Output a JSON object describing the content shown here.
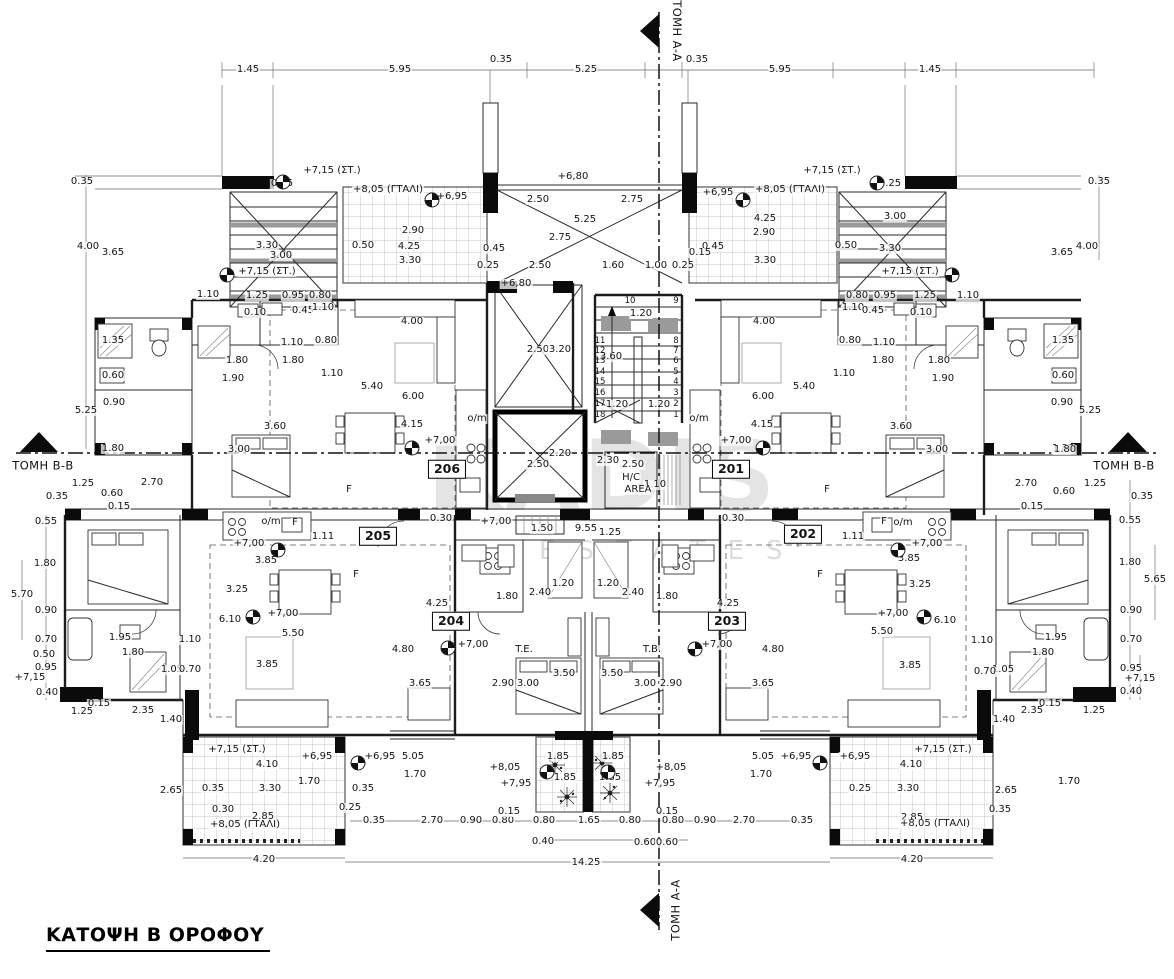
{
  "title": {
    "text": "ΚΑΤΟΨΗ Β ΟΡΟΦΟΥ"
  },
  "watermark": {
    "line1": "KADIS",
    "line2": "ESTATES"
  },
  "colors": {
    "paper": "#ffffff",
    "line": "#1c1c1c",
    "tile_grid": "#c4c4c4",
    "gray_fill": "#9a9a9a",
    "watermark": "#e4e4e4"
  },
  "section_markers": [
    {
      "position": "top",
      "label": "ΤΟΜΗ Α-Α"
    },
    {
      "position": "bottom",
      "label": "ΤΟΜΗ Α-Α"
    },
    {
      "position": "left",
      "label": "ΤΟΜΗ Β-Β"
    },
    {
      "position": "right",
      "label": "ΤΟΜΗ Β-Β"
    }
  ],
  "apartments": [
    "201",
    "202",
    "203",
    "204",
    "205",
    "206"
  ],
  "plan": {
    "label_format": "[text, x, y, class?, rotation?] class: r=room-box, s=stair-tread, m=section-marker",
    "labels": [
      [
        "1.45",
        248,
        70
      ],
      [
        "5.95",
        400,
        70
      ],
      [
        "0.35",
        501,
        60
      ],
      [
        "5.25",
        586,
        70
      ],
      [
        "0.35",
        697,
        60
      ],
      [
        "5.95",
        780,
        70
      ],
      [
        "1.45",
        930,
        70
      ],
      [
        "0.35",
        82,
        182
      ],
      [
        "0.35",
        1099,
        182
      ],
      [
        "4.00",
        88,
        247
      ],
      [
        "3.65",
        113,
        253
      ],
      [
        "4.00",
        1087,
        247
      ],
      [
        "3.65",
        1062,
        253
      ],
      [
        "+7,15 (ΣΤ.)",
        332,
        171
      ],
      [
        "0.25",
        282,
        184
      ],
      [
        "+8,05 (ΓΤΑΛΙ)",
        388,
        190
      ],
      [
        "+6,95",
        452,
        197
      ],
      [
        "+6,80",
        573,
        177
      ],
      [
        "+6,95",
        718,
        193
      ],
      [
        "+8,05 (ΓΤΑΛΙ)",
        790,
        190
      ],
      [
        "+7,15 (ΣΤ.)",
        832,
        171
      ],
      [
        "0.25",
        890,
        184
      ],
      [
        "2.50",
        538,
        200
      ],
      [
        "2.75",
        632,
        200
      ],
      [
        "5.25",
        585,
        220
      ],
      [
        "2.75",
        560,
        238
      ],
      [
        "2.90",
        413,
        231
      ],
      [
        "4.25",
        409,
        247
      ],
      [
        "3.30",
        410,
        261
      ],
      [
        "0.50",
        363,
        246
      ],
      [
        "3.30",
        267,
        246
      ],
      [
        "3.00",
        281,
        256
      ],
      [
        "4.25",
        765,
        219
      ],
      [
        "2.90",
        764,
        233
      ],
      [
        "3.30",
        765,
        261
      ],
      [
        "0.50",
        846,
        246
      ],
      [
        "3.00",
        895,
        217
      ],
      [
        "3.30",
        890,
        249
      ],
      [
        "+7,15 (ΣΤ.)",
        267,
        272
      ],
      [
        "+7,15 (ΣΤ.)",
        910,
        272
      ],
      [
        "2.50",
        540,
        266
      ],
      [
        "1.60",
        613,
        266
      ],
      [
        "1.00",
        656,
        266
      ],
      [
        "0.25",
        683,
        266
      ],
      [
        "0.25",
        488,
        266
      ],
      [
        "0.45",
        494,
        249
      ],
      [
        "0.45",
        713,
        247
      ],
      [
        "0.15",
        700,
        253
      ],
      [
        "+6,80",
        516,
        284
      ],
      [
        "1.10",
        208,
        295
      ],
      [
        "1.25",
        257,
        296
      ],
      [
        "0.95",
        293,
        296
      ],
      [
        "0.80",
        320,
        296
      ],
      [
        "0.80",
        857,
        296
      ],
      [
        "0.95",
        885,
        296
      ],
      [
        "1.25",
        925,
        296
      ],
      [
        "1.10",
        968,
        296
      ],
      [
        "0.10",
        255,
        313
      ],
      [
        "0.45",
        303,
        311
      ],
      [
        "1.10",
        323,
        308
      ],
      [
        "1.10",
        853,
        308
      ],
      [
        "0.45",
        873,
        311
      ],
      [
        "0.10",
        921,
        313
      ],
      [
        "4.00",
        412,
        322
      ],
      [
        "4.00",
        764,
        322
      ],
      [
        "1.80",
        237,
        361
      ],
      [
        "1.90",
        233,
        379
      ],
      [
        "1.10",
        292,
        343
      ],
      [
        "1.80",
        293,
        361
      ],
      [
        "1.10",
        332,
        374
      ],
      [
        "0.80",
        326,
        341
      ],
      [
        "5.40",
        372,
        387
      ],
      [
        "6.00",
        413,
        397
      ],
      [
        "4.15",
        412,
        425
      ],
      [
        "+7,00",
        440,
        441
      ],
      [
        "o/m",
        477,
        419
      ],
      [
        "1.80",
        939,
        361
      ],
      [
        "1.90",
        943,
        379
      ],
      [
        "1.10",
        884,
        343
      ],
      [
        "1.80",
        883,
        361
      ],
      [
        "1.10",
        844,
        374
      ],
      [
        "0.80",
        850,
        341
      ],
      [
        "5.40",
        804,
        387
      ],
      [
        "6.00",
        763,
        397
      ],
      [
        "4.15",
        762,
        425
      ],
      [
        "+7,00",
        736,
        441
      ],
      [
        "o/m",
        699,
        419
      ],
      [
        "3.60",
        275,
        427
      ],
      [
        "3.00",
        239,
        450
      ],
      [
        "3.60",
        901,
        427
      ],
      [
        "3.00",
        937,
        450
      ],
      [
        "1.35",
        113,
        341
      ],
      [
        "0.60",
        113,
        376
      ],
      [
        "0.90",
        114,
        403
      ],
      [
        "5.25",
        86,
        411
      ],
      [
        "1.80",
        113,
        449
      ],
      [
        "1.35",
        1063,
        341
      ],
      [
        "0.60",
        1063,
        376
      ],
      [
        "0.90",
        1062,
        403
      ],
      [
        "5.25",
        1090,
        411
      ],
      [
        "1.80",
        1063,
        449
      ],
      [
        "2.50",
        538,
        350
      ],
      [
        "3.20",
        560,
        350
      ],
      [
        "1.20",
        641,
        314
      ],
      [
        "3.60",
        611,
        357
      ],
      [
        "1.20",
        617,
        405
      ],
      [
        "1.20",
        659,
        405
      ],
      [
        "10",
        630,
        301,
        "s"
      ],
      [
        "9",
        676,
        301,
        "s"
      ],
      [
        "11",
        600,
        341,
        "s"
      ],
      [
        "8",
        676,
        341,
        "s"
      ],
      [
        "12",
        600,
        351,
        "s"
      ],
      [
        "7",
        676,
        351,
        "s"
      ],
      [
        "13",
        600,
        361,
        "s"
      ],
      [
        "6",
        676,
        361,
        "s"
      ],
      [
        "14",
        600,
        372,
        "s"
      ],
      [
        "5",
        676,
        372,
        "s"
      ],
      [
        "15",
        600,
        382,
        "s"
      ],
      [
        "4",
        676,
        382,
        "s"
      ],
      [
        "16",
        600,
        393,
        "s"
      ],
      [
        "3",
        676,
        393,
        "s"
      ],
      [
        "17",
        600,
        404,
        "s"
      ],
      [
        "2",
        676,
        404,
        "s"
      ],
      [
        "18",
        600,
        415,
        "s"
      ],
      [
        "1",
        676,
        415,
        "s"
      ],
      [
        "2.20",
        560,
        454
      ],
      [
        "2.50",
        538,
        465
      ],
      [
        "2.30",
        608,
        461
      ],
      [
        "2.50",
        633,
        465
      ],
      [
        "1.10",
        655,
        485
      ],
      [
        "H/C",
        631,
        478
      ],
      [
        "AREA",
        638,
        490
      ],
      [
        "0.30",
        441,
        519
      ],
      [
        "+7,00",
        496,
        522
      ],
      [
        "1.50",
        542,
        529
      ],
      [
        "9.55",
        586,
        529
      ],
      [
        "1.25",
        610,
        533
      ],
      [
        "0.30",
        733,
        519
      ],
      [
        "0.35",
        57,
        497
      ],
      [
        "1.25",
        83,
        484
      ],
      [
        "2.70",
        152,
        483
      ],
      [
        "0.60",
        112,
        494
      ],
      [
        "0.15",
        119,
        507
      ],
      [
        "0.55",
        46,
        522
      ],
      [
        "1.80",
        45,
        564
      ],
      [
        "0.35",
        1142,
        497
      ],
      [
        "1.25",
        1095,
        484
      ],
      [
        "2.70",
        1026,
        484
      ],
      [
        "0.60",
        1064,
        492
      ],
      [
        "0.15",
        1032,
        507
      ],
      [
        "0.55",
        1130,
        521
      ],
      [
        "1.80",
        1130,
        563
      ],
      [
        "1.80",
        1065,
        450
      ],
      [
        "o/m",
        271,
        522
      ],
      [
        "F",
        295,
        523
      ],
      [
        "F",
        884,
        522
      ],
      [
        "o/m",
        903,
        523
      ],
      [
        "1.11",
        323,
        537
      ],
      [
        "1.11",
        853,
        537
      ],
      [
        "+7,00",
        249,
        544
      ],
      [
        "+7,00",
        927,
        544
      ],
      [
        "F",
        349,
        490
      ],
      [
        "F",
        827,
        490
      ],
      [
        "F",
        356,
        575
      ],
      [
        "F",
        820,
        575
      ],
      [
        "3.85",
        266,
        561
      ],
      [
        "3.25",
        237,
        590
      ],
      [
        "6.10",
        230,
        620
      ],
      [
        "+7,00",
        283,
        614
      ],
      [
        "5.50",
        293,
        634
      ],
      [
        "3.85",
        267,
        665
      ],
      [
        "1.10",
        190,
        640
      ],
      [
        "1.95",
        120,
        638
      ],
      [
        "1.80",
        133,
        653
      ],
      [
        "1.05",
        172,
        670
      ],
      [
        "0.70",
        190,
        670
      ],
      [
        "3.85",
        909,
        559
      ],
      [
        "3.25",
        920,
        585
      ],
      [
        "6.10",
        945,
        621
      ],
      [
        "+7,00",
        893,
        614
      ],
      [
        "5.50",
        882,
        632
      ],
      [
        "3.85",
        910,
        666
      ],
      [
        "1.10",
        982,
        641
      ],
      [
        "1.95",
        1056,
        638
      ],
      [
        "1.80",
        1043,
        653
      ],
      [
        "1.05",
        1003,
        670
      ],
      [
        "0.70",
        985,
        672
      ],
      [
        "4.25",
        437,
        604
      ],
      [
        "4.25",
        728,
        604
      ],
      [
        "1.80",
        507,
        597
      ],
      [
        "1.80",
        667,
        597
      ],
      [
        "2.40",
        540,
        593
      ],
      [
        "2.40",
        633,
        593
      ],
      [
        "1.20",
        563,
        584
      ],
      [
        "1.20",
        608,
        584
      ],
      [
        "+7,00",
        473,
        645
      ],
      [
        "+7,00",
        717,
        645
      ],
      [
        "T.E.",
        524,
        650
      ],
      [
        "T.B.",
        652,
        650
      ],
      [
        "3.50",
        564,
        674
      ],
      [
        "3.50",
        612,
        674
      ],
      [
        "3.00",
        528,
        684
      ],
      [
        "3.00",
        645,
        684
      ],
      [
        "2.90",
        503,
        684
      ],
      [
        "2.90",
        671,
        684
      ],
      [
        "3.65",
        420,
        684
      ],
      [
        "3.65",
        763,
        684
      ],
      [
        "4.80",
        403,
        650
      ],
      [
        "4.80",
        773,
        650
      ],
      [
        "5.70",
        22,
        595
      ],
      [
        "0.90",
        46,
        611
      ],
      [
        "0.70",
        46,
        640
      ],
      [
        "0.50",
        44,
        655
      ],
      [
        "0.95",
        46,
        668
      ],
      [
        "+7,15",
        30,
        678
      ],
      [
        "0.40",
        47,
        693
      ],
      [
        "5.65",
        1155,
        580
      ],
      [
        "0.90",
        1131,
        611
      ],
      [
        "0.70",
        1131,
        640
      ],
      [
        "0.95",
        1131,
        669
      ],
      [
        "+7,15",
        1140,
        679
      ],
      [
        "0.40",
        1131,
        692
      ],
      [
        "0.15",
        99,
        704
      ],
      [
        "1.25",
        82,
        712
      ],
      [
        "2.35",
        143,
        711
      ],
      [
        "1.40",
        171,
        720
      ],
      [
        "2.65",
        171,
        791
      ],
      [
        "0.15",
        1050,
        704
      ],
      [
        "1.25",
        1094,
        711
      ],
      [
        "2.35",
        1032,
        711
      ],
      [
        "1.40",
        1004,
        720
      ],
      [
        "2.65",
        1006,
        791
      ],
      [
        "+7,15 (ΣΤ.)",
        237,
        750
      ],
      [
        "+7,15 (ΣΤ.)",
        943,
        750
      ],
      [
        "4.10",
        267,
        765
      ],
      [
        "4.10",
        911,
        765
      ],
      [
        "0.35",
        213,
        789
      ],
      [
        "3.30",
        270,
        789
      ],
      [
        "0.25",
        860,
        789
      ],
      [
        "3.30",
        908,
        789
      ],
      [
        "0.30",
        223,
        810
      ],
      [
        "0.35",
        1000,
        810
      ],
      [
        "2.85",
        263,
        817
      ],
      [
        "2.85",
        912,
        818
      ],
      [
        "+8,05 (ΓΤΑΛΙ)",
        245,
        825
      ],
      [
        "+8,05 (ΓΤΑΛΙ)",
        935,
        824
      ],
      [
        "+6,95",
        317,
        757
      ],
      [
        "+6,95",
        380,
        757
      ],
      [
        "+6,95",
        796,
        757
      ],
      [
        "+6,95",
        855,
        757
      ],
      [
        "5.05",
        413,
        757
      ],
      [
        "5.05",
        763,
        757
      ],
      [
        "1.70",
        415,
        775
      ],
      [
        "1.70",
        761,
        775
      ],
      [
        "1.70",
        309,
        782
      ],
      [
        "1.70",
        1069,
        782
      ],
      [
        "+8,05",
        505,
        768
      ],
      [
        "+8,05",
        671,
        768
      ],
      [
        "+7,95",
        516,
        784
      ],
      [
        "+7,95",
        660,
        784
      ],
      [
        "1.85",
        558,
        757
      ],
      [
        "1.85",
        613,
        757
      ],
      [
        "1.85",
        565,
        778
      ],
      [
        "1.85",
        610,
        778
      ],
      [
        "0.35",
        363,
        789
      ],
      [
        "0.25",
        350,
        808
      ],
      [
        "0.35",
        374,
        821
      ],
      [
        "2.70",
        432,
        821
      ],
      [
        "0.90",
        471,
        821
      ],
      [
        "0.80",
        503,
        821
      ],
      [
        "0.15",
        509,
        812
      ],
      [
        "0.80",
        544,
        821
      ],
      [
        "1.65",
        589,
        821
      ],
      [
        "0.80",
        630,
        821
      ],
      [
        "0.15",
        667,
        812
      ],
      [
        "0.80",
        673,
        821
      ],
      [
        "0.90",
        705,
        821
      ],
      [
        "2.70",
        744,
        821
      ],
      [
        "0.35",
        802,
        821
      ],
      [
        "0.40",
        543,
        842
      ],
      [
        "0.60",
        645,
        843
      ],
      [
        "0.60",
        667,
        843
      ],
      [
        "4.20",
        264,
        860
      ],
      [
        "4.20",
        912,
        860
      ],
      [
        "14.25",
        586,
        863
      ],
      [
        "206",
        447,
        469,
        "r"
      ],
      [
        "201",
        731,
        469,
        "r"
      ],
      [
        "205",
        378,
        536,
        "r"
      ],
      [
        "202",
        803,
        534,
        "r"
      ],
      [
        "204",
        451,
        621,
        "r"
      ],
      [
        "203",
        727,
        621,
        "r"
      ],
      [
        "ΤΟΜΗ Α-Α",
        676,
        31,
        "m",
        90
      ],
      [
        "ΤΟΜΗ Α-Α",
        676,
        910,
        "m",
        -90
      ],
      [
        "ΤΟΜΗ Β-Β",
        43,
        466,
        "m",
        0
      ],
      [
        "ΤΟΜΗ Β-Β",
        1124,
        466,
        "m",
        0
      ]
    ],
    "level_marks": [
      [
        412,
        448
      ],
      [
        763,
        448
      ],
      [
        253,
        617
      ],
      [
        924,
        617
      ],
      [
        278,
        550
      ],
      [
        898,
        550
      ],
      [
        448,
        648
      ],
      [
        695,
        649
      ],
      [
        432,
        200
      ],
      [
        743,
        200
      ],
      [
        283,
        182
      ],
      [
        877,
        183
      ],
      [
        227,
        275
      ],
      [
        952,
        275
      ],
      [
        358,
        763
      ],
      [
        820,
        763
      ],
      [
        547,
        772
      ],
      [
        608,
        772
      ]
    ]
  }
}
